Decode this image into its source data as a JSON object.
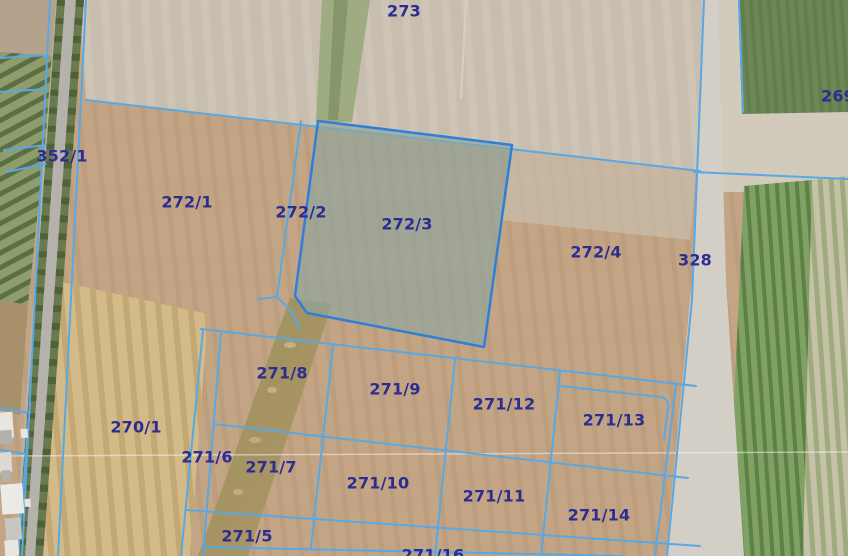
{
  "map": {
    "selected_parcel": "272/3",
    "parcel_labels": [
      {
        "text": "273"
      },
      {
        "text": "269"
      },
      {
        "text": "352/1"
      },
      {
        "text": "272/1"
      },
      {
        "text": "272/2"
      },
      {
        "text": "272/3"
      },
      {
        "text": "272/4"
      },
      {
        "text": "328"
      },
      {
        "text": "271/8"
      },
      {
        "text": "271/9"
      },
      {
        "text": "271/12"
      },
      {
        "text": "271/13"
      },
      {
        "text": "270/1"
      },
      {
        "text": "271/6"
      },
      {
        "text": "271/7"
      },
      {
        "text": "271/10"
      },
      {
        "text": "271/11"
      },
      {
        "text": "271/14"
      },
      {
        "text": "271/5"
      },
      {
        "text": "271/16"
      }
    ],
    "colors": {
      "label_text": "#2d2d90",
      "parcel_boundary": "#58a8e6",
      "selection_stroke": "#2f7fd6",
      "selection_fill": "rgba(145,165,158,0.68)"
    }
  }
}
